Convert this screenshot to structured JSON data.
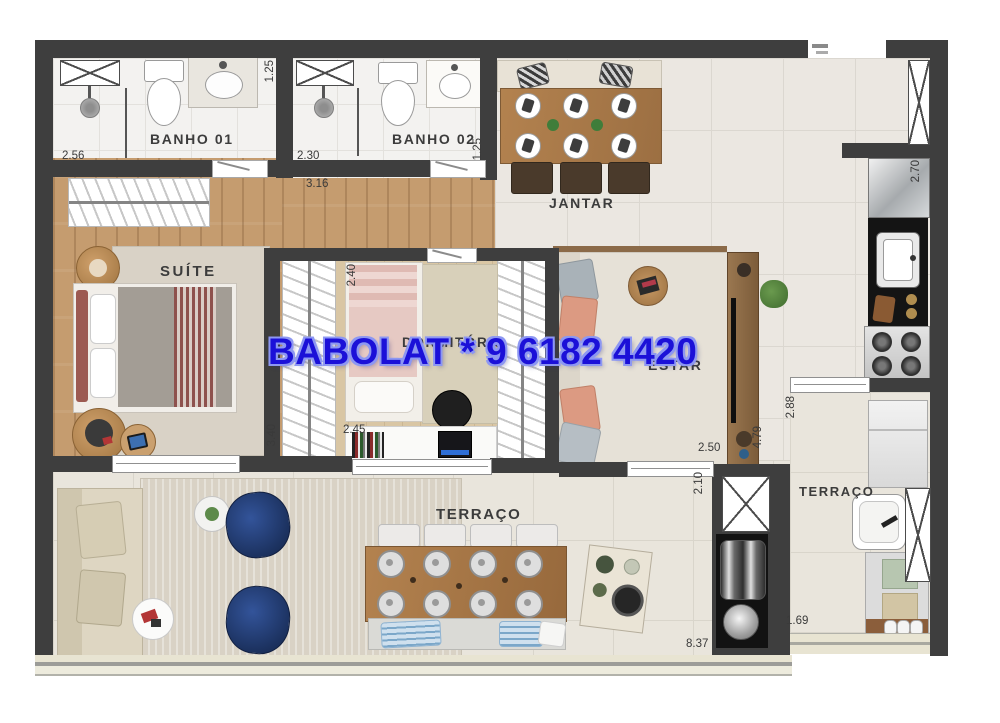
{
  "watermark": {
    "text": "BABOLAT * 9 6182 4420"
  },
  "rooms": {
    "banho1": {
      "label": "BANHO 01",
      "width_m": "2.56",
      "depth_m": "1.25"
    },
    "banho2": {
      "label": "BANHO 02",
      "width_m": "2.30",
      "depth_m": "1.25"
    },
    "hall": {
      "width_m": "3.16"
    },
    "jantar": {
      "label": "JANTAR"
    },
    "suite": {
      "label": "SUÍTE",
      "depth_m": "3.40"
    },
    "dormitorio": {
      "label": "DORMITÓRIO",
      "depth_m": "2.40",
      "width_m": "2.45"
    },
    "estar": {
      "label": "ESTAR",
      "width_m": "2.50",
      "depth_m": "4.79"
    },
    "cozinha": {
      "depth_m": "2.70"
    },
    "churrasqueira": {
      "depth_m": "2.10"
    },
    "terraco": {
      "label": "TERRAÇO",
      "width_m": "8.37"
    },
    "terraco_servico": {
      "label": "TERRAÇO",
      "width_m": "2.88",
      "depth_m": "1.69"
    }
  },
  "colors": {
    "wall": "#3e3e3e",
    "watermark": "#1b10d8",
    "wood_floor": "#c59c6f",
    "tile_floor": "#ebe7e1",
    "navy_chair": "#1e3260"
  }
}
